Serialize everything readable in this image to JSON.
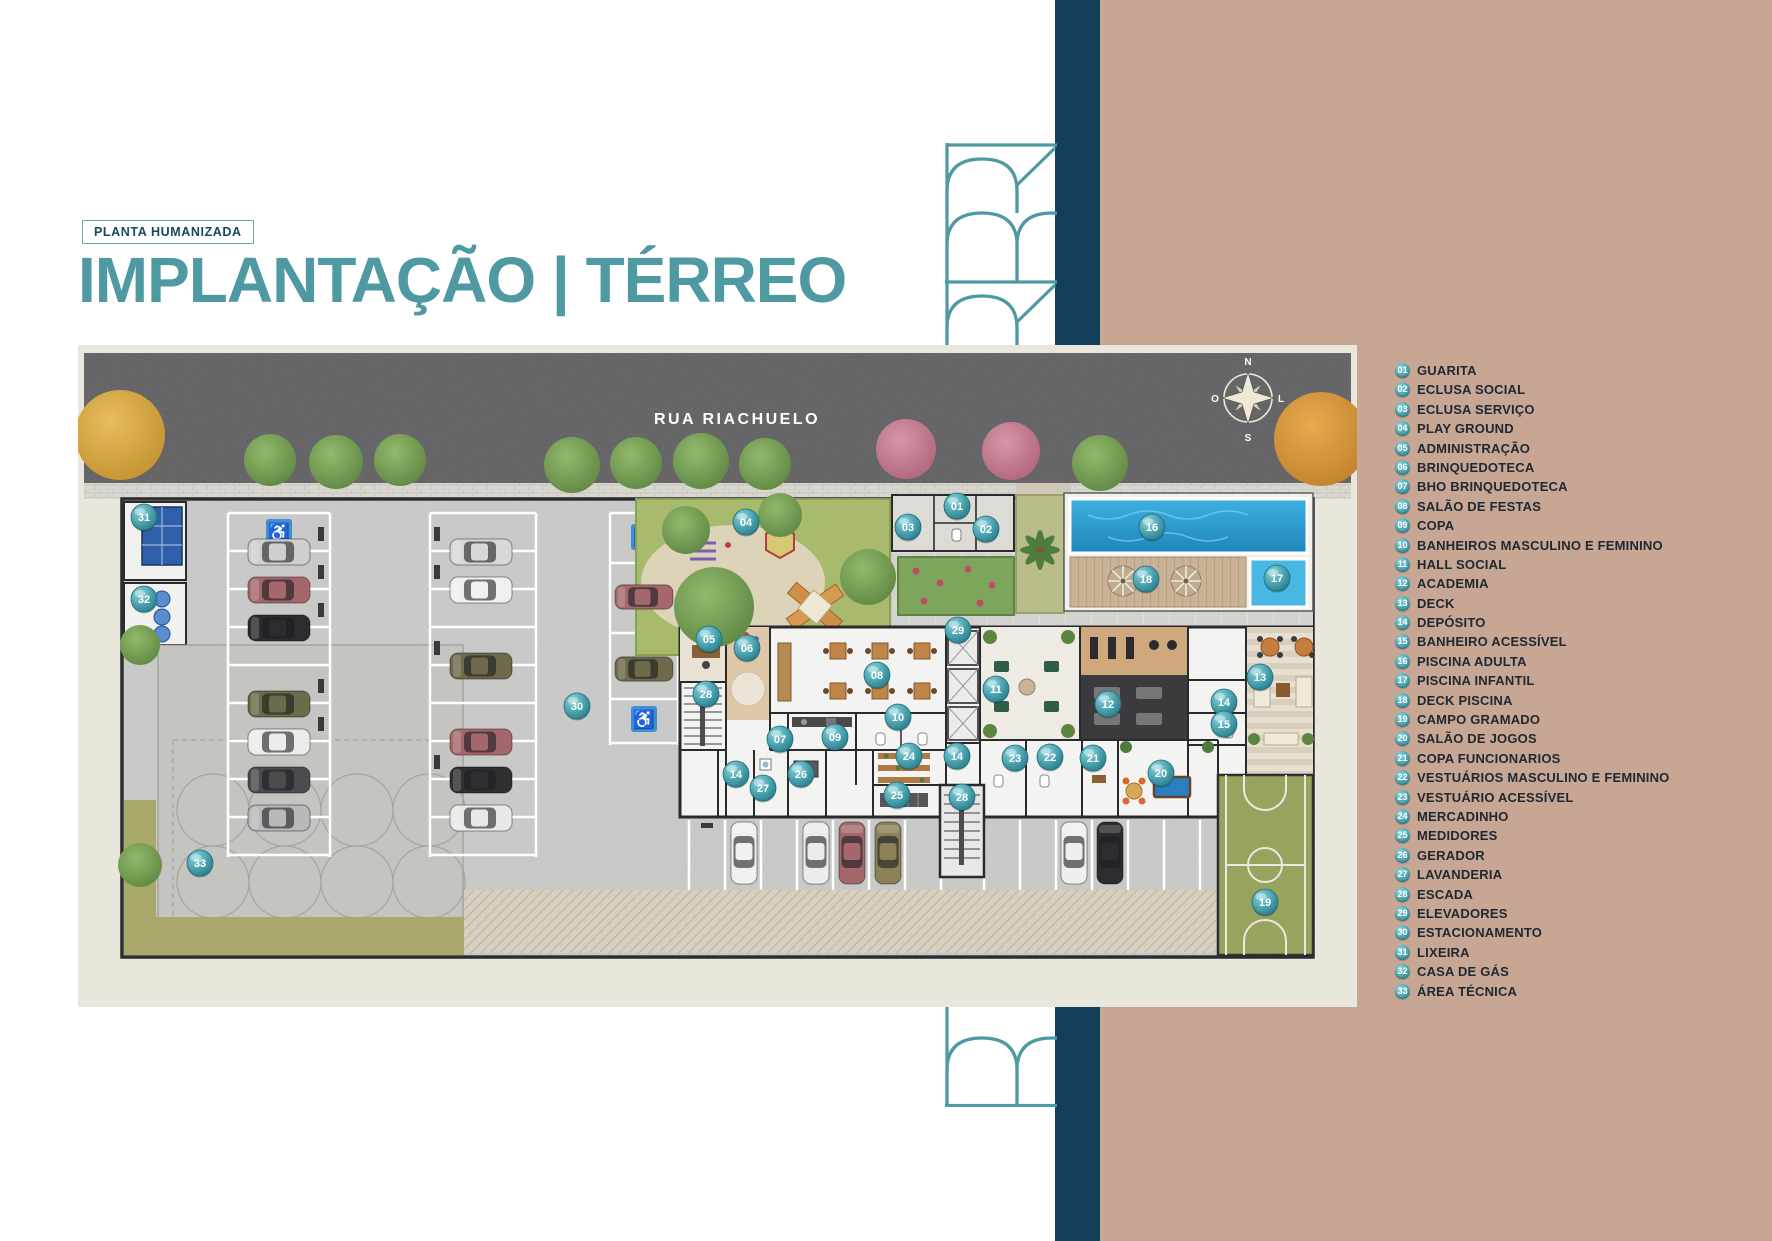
{
  "page": {
    "tag": "PLANTA HUMANIZADA",
    "title": "IMPLANTAÇÃO | TÉRREO"
  },
  "plan": {
    "street_name": "RUA RIACHUELO",
    "compass": {
      "n": "N",
      "s": "S",
      "e": "L",
      "w": "O"
    },
    "markers": [
      {
        "n": "01",
        "x": 879,
        "y": 161
      },
      {
        "n": "02",
        "x": 908,
        "y": 184
      },
      {
        "n": "03",
        "x": 830,
        "y": 182
      },
      {
        "n": "04",
        "x": 668,
        "y": 177
      },
      {
        "n": "05",
        "x": 631,
        "y": 294
      },
      {
        "n": "06",
        "x": 669,
        "y": 303
      },
      {
        "n": "07",
        "x": 702,
        "y": 394
      },
      {
        "n": "08",
        "x": 799,
        "y": 330
      },
      {
        "n": "09",
        "x": 757,
        "y": 392
      },
      {
        "n": "10",
        "x": 820,
        "y": 372
      },
      {
        "n": "11",
        "x": 918,
        "y": 344
      },
      {
        "n": "12",
        "x": 1030,
        "y": 359
      },
      {
        "n": "13",
        "x": 1182,
        "y": 332
      },
      {
        "n": "14",
        "x": 1146,
        "y": 357
      },
      {
        "n": "15",
        "x": 1146,
        "y": 379
      },
      {
        "n": "16",
        "x": 1074,
        "y": 182
      },
      {
        "n": "17",
        "x": 1199,
        "y": 233
      },
      {
        "n": "18",
        "x": 1068,
        "y": 234
      },
      {
        "n": "19",
        "x": 1187,
        "y": 557
      },
      {
        "n": "20",
        "x": 1083,
        "y": 428
      },
      {
        "n": "21",
        "x": 1015,
        "y": 413
      },
      {
        "n": "22",
        "x": 972,
        "y": 412
      },
      {
        "n": "23",
        "x": 937,
        "y": 413
      },
      {
        "n": "24",
        "x": 831,
        "y": 411
      },
      {
        "n": "25",
        "x": 819,
        "y": 450
      },
      {
        "n": "26",
        "x": 723,
        "y": 429
      },
      {
        "n": "27",
        "x": 685,
        "y": 443
      },
      {
        "n": "28",
        "x": 628,
        "y": 349
      },
      {
        "n": "28",
        "x": 884,
        "y": 452
      },
      {
        "n": "29",
        "x": 880,
        "y": 285
      },
      {
        "n": "30",
        "x": 499,
        "y": 361
      },
      {
        "n": "31",
        "x": 66,
        "y": 172
      },
      {
        "n": "32",
        "x": 66,
        "y": 254
      },
      {
        "n": "33",
        "x": 122,
        "y": 518
      },
      {
        "n": "14",
        "x": 879,
        "y": 411
      },
      {
        "n": "14",
        "x": 658,
        "y": 429
      }
    ]
  },
  "legend": {
    "items": [
      {
        "n": "01",
        "label": "GUARITA"
      },
      {
        "n": "02",
        "label": "ECLUSA SOCIAL"
      },
      {
        "n": "03",
        "label": "ECLUSA SERVIÇO"
      },
      {
        "n": "04",
        "label": "PLAY GROUND"
      },
      {
        "n": "05",
        "label": "ADMINISTRAÇÃO"
      },
      {
        "n": "06",
        "label": "BRINQUEDOTECA"
      },
      {
        "n": "07",
        "label": "BHO BRINQUEDOTECA"
      },
      {
        "n": "08",
        "label": "SALÃO DE FESTAS"
      },
      {
        "n": "09",
        "label": "COPA"
      },
      {
        "n": "10",
        "label": "BANHEIROS MASCULINO E FEMININO"
      },
      {
        "n": "11",
        "label": "HALL SOCIAL"
      },
      {
        "n": "12",
        "label": "ACADEMIA"
      },
      {
        "n": "13",
        "label": "DECK"
      },
      {
        "n": "14",
        "label": "DEPÓSITO"
      },
      {
        "n": "15",
        "label": "BANHEIRO ACESSÍVEL"
      },
      {
        "n": "16",
        "label": "PISCINA ADULTA"
      },
      {
        "n": "17",
        "label": "PISCINA INFANTIL"
      },
      {
        "n": "18",
        "label": "DECK PISCINA"
      },
      {
        "n": "19",
        "label": "CAMPO GRAMADO"
      },
      {
        "n": "20",
        "label": "SALÃO DE JOGOS"
      },
      {
        "n": "21",
        "label": "COPA FUNCIONARIOS"
      },
      {
        "n": "22",
        "label": "VESTUÁRIOS MASCULINO E FEMININO"
      },
      {
        "n": "23",
        "label": "VESTUÁRIO ACESSÍVEL"
      },
      {
        "n": "24",
        "label": "MERCADINHO"
      },
      {
        "n": "25",
        "label": "MEDIDORES"
      },
      {
        "n": "26",
        "label": "GERADOR"
      },
      {
        "n": "27",
        "label": "LAVANDERIA"
      },
      {
        "n": "28",
        "label": "ESCADA"
      },
      {
        "n": "29",
        "label": "ELEVADORES"
      },
      {
        "n": "30",
        "label": "ESTACIONAMENTO"
      },
      {
        "n": "31",
        "label": "LIXEIRA"
      },
      {
        "n": "32",
        "label": "CASA DE GÁS"
      },
      {
        "n": "33",
        "label": "ÁREA TÉCNICA"
      }
    ]
  },
  "colors": {
    "accent_teal": "#4f9aa2",
    "navy": "#143f5b",
    "tan": "#c8a694",
    "marker": "#3a8e9c",
    "asphalt": "#59595b",
    "pool": "#2b9fd4"
  }
}
